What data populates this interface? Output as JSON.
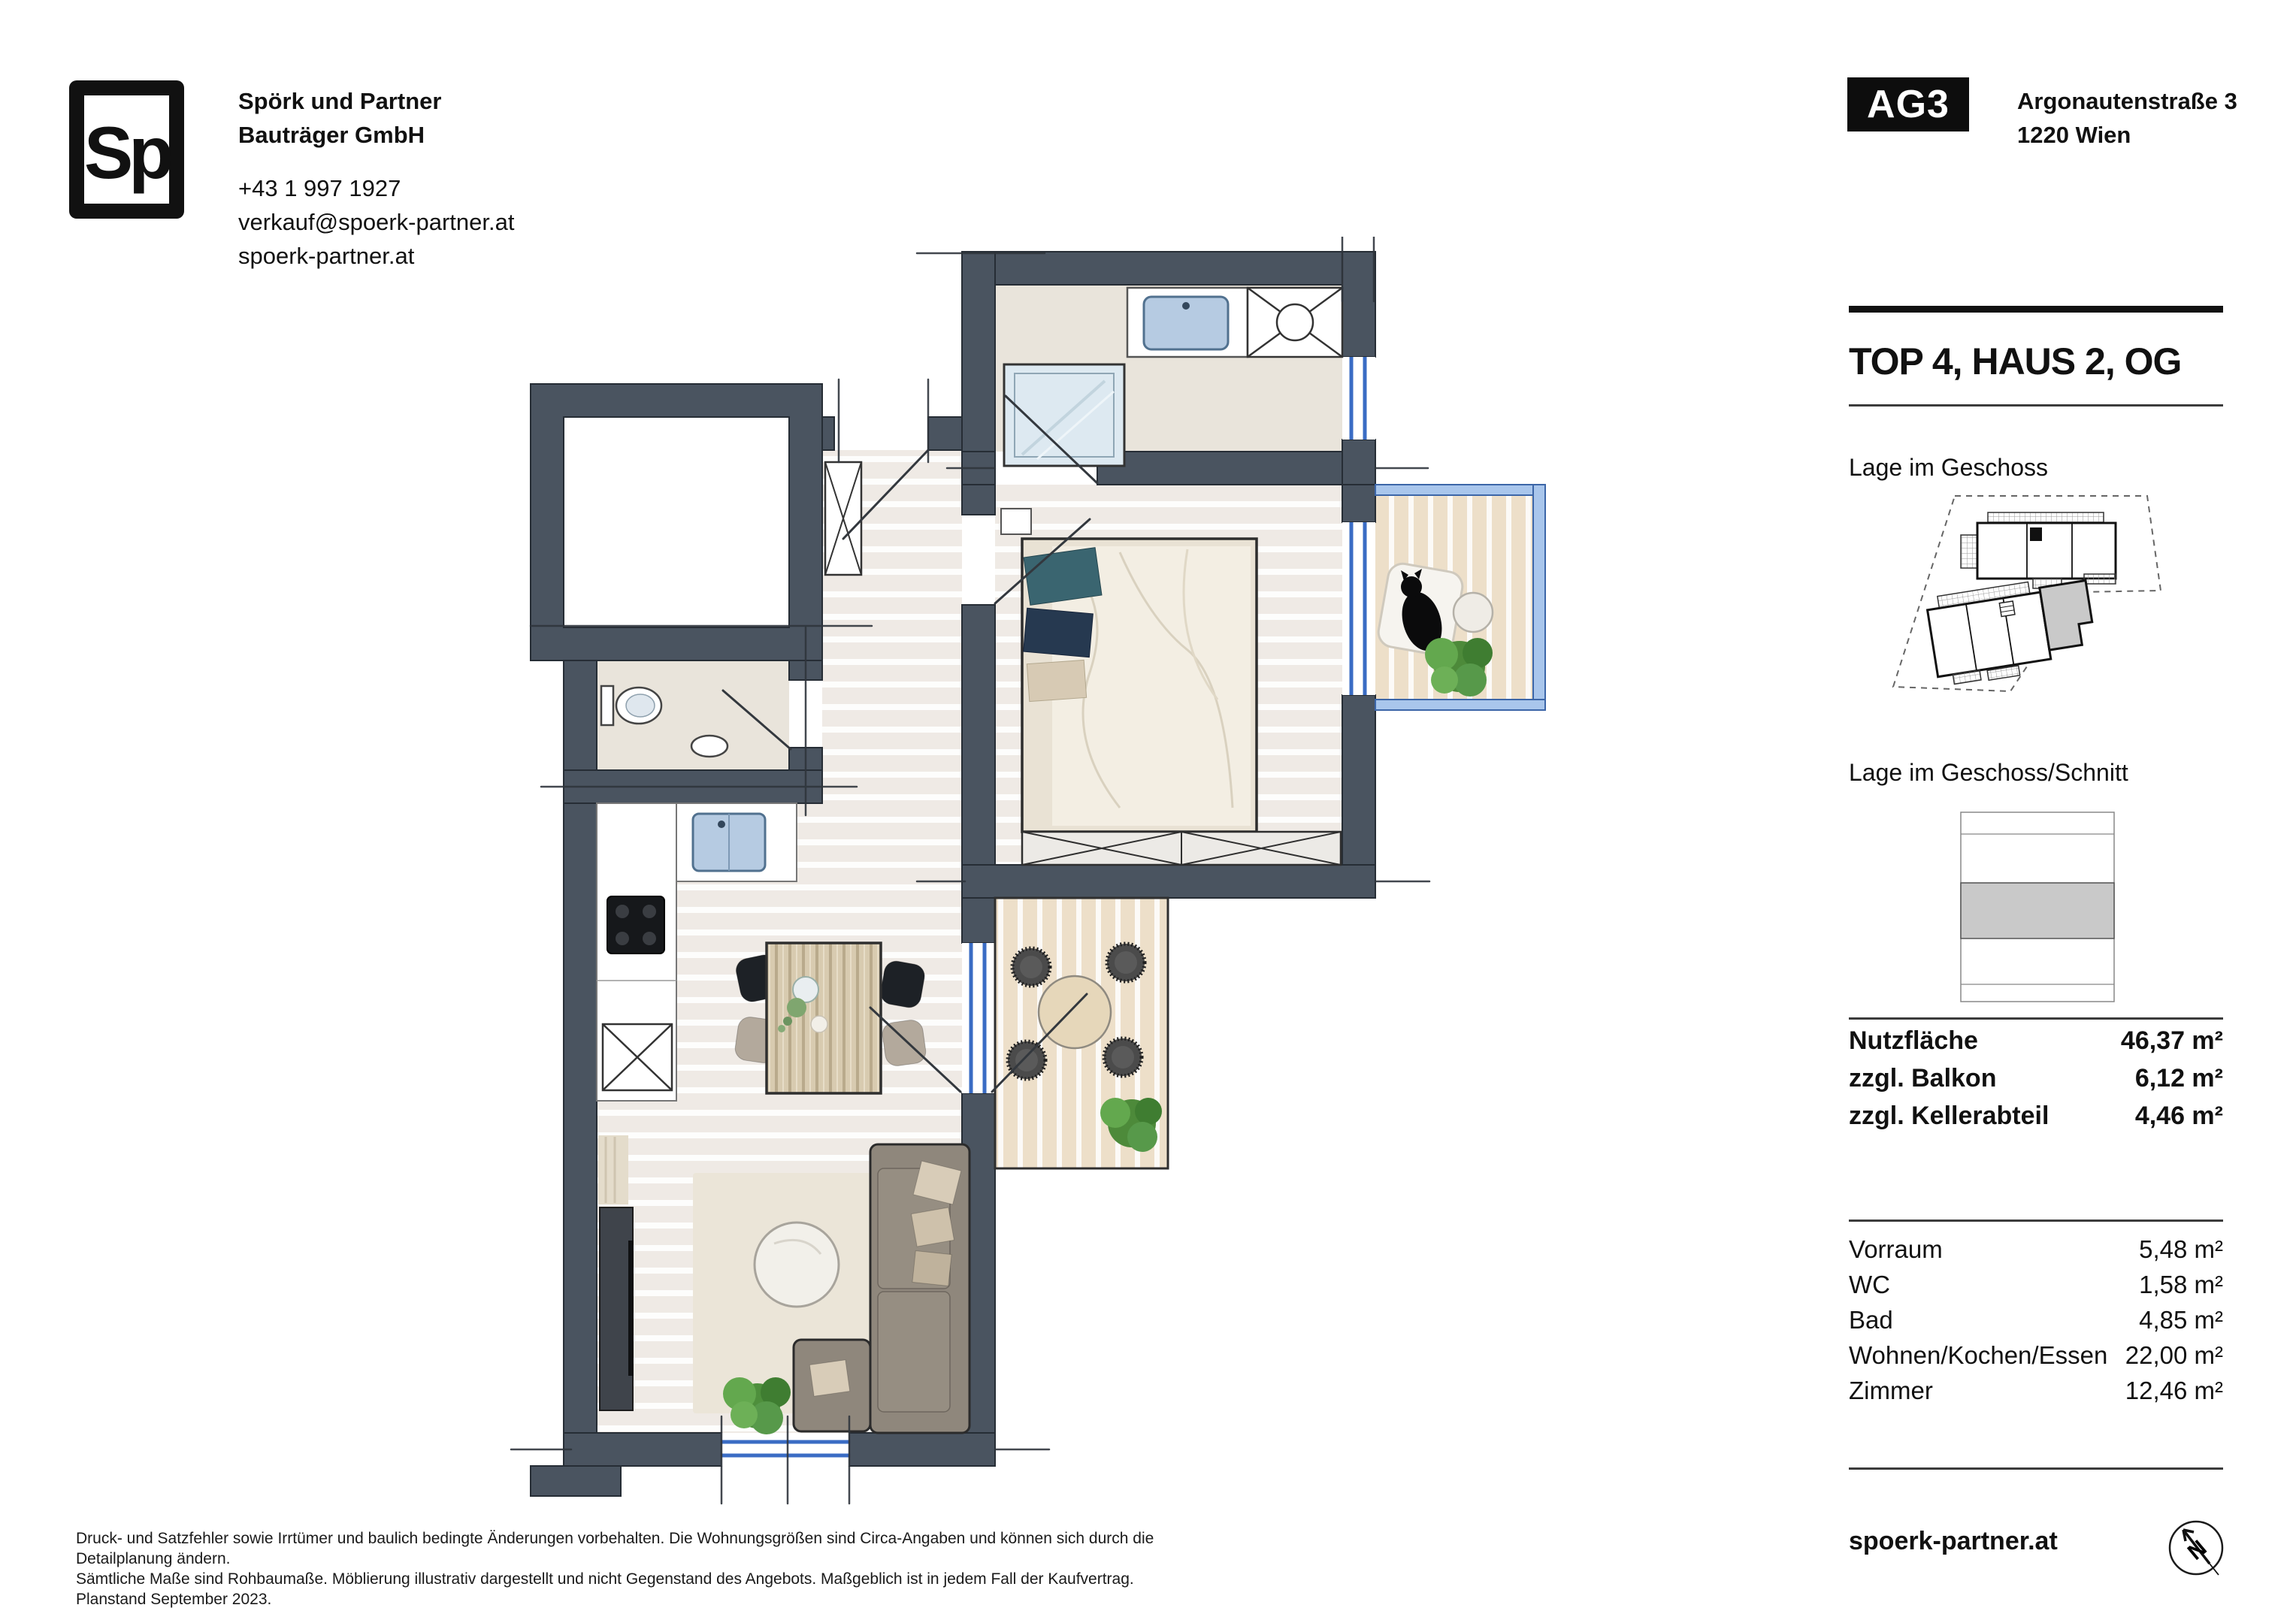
{
  "header": {
    "logo_text": "Sp",
    "company_line1": "Spörk und Partner",
    "company_line2": "Bauträger GmbH",
    "phone": "+43 1 997 1927",
    "email": "verkauf@spoerk-partner.at",
    "website": "spoerk-partner.at",
    "project_badge": "AG3",
    "address_line1": "Argonautenstraße 3",
    "address_line2": "1220 Wien"
  },
  "sidebar": {
    "title": "TOP 4, HAUS 2, OG",
    "section1_label": "Lage im Geschoss",
    "section2_label": "Lage im Geschoss/Schnitt",
    "area_summary": [
      {
        "label": "Nutzfläche",
        "value": "46,37 m²"
      },
      {
        "label": "zzgl. Balkon",
        "value": "6,12 m²"
      },
      {
        "label": "zzgl. Kellerabteil",
        "value": "4,46 m²"
      }
    ],
    "rooms": [
      {
        "label": "Vorraum",
        "value": "5,48 m²"
      },
      {
        "label": "WC",
        "value": "1,58 m²"
      },
      {
        "label": "Bad",
        "value": "4,85 m²"
      },
      {
        "label": "Wohnen/Kochen/Essen",
        "value": "22,00 m²"
      },
      {
        "label": "Zimmer",
        "value": "12,46 m²"
      }
    ],
    "footer_website": "spoerk-partner.at",
    "compass_letter": "N"
  },
  "footer": {
    "disclaimer_line1": "Druck- und Satzfehler sowie Irrtümer und baulich bedingte Änderungen vorbehalten. Die Wohnungsgrößen sind Circa-Angaben und können sich durch die Detailplanung ändern.",
    "disclaimer_line2": "Sämtliche Maße sind Rohbaumaße. Möblierung illustrativ dargestellt und nicht Gegenstand des Angebots. Maßgeblich ist in jedem Fall der Kaufvertrag. Planstand September 2023."
  },
  "colors": {
    "wall": "#4a5460",
    "window_blue": "#3a6cc4",
    "balcony_frame": "#a9c6ec",
    "tile_floor": "#e9e4db",
    "wood_floor": "#efeae5",
    "balcony_wood": "#eddfc9",
    "section_highlight": "#c9c9c9",
    "badge_bg": "#0d0d0d"
  }
}
